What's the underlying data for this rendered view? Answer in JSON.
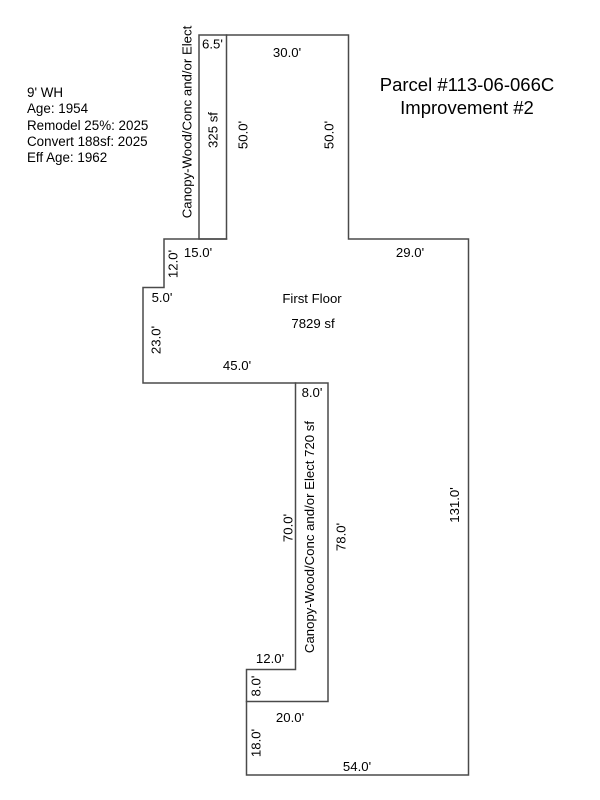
{
  "colors": {
    "line": "#4a4a4a",
    "text": "#000000",
    "background": "#ffffff"
  },
  "info_block": {
    "lines": [
      "9' WH",
      "Age: 1954",
      "Remodel 25%: 2025",
      "Convert 188sf: 2025",
      "Eff Age: 1962"
    ]
  },
  "title": {
    "parcel": "Parcel #113-06-066C",
    "improvement": "Improvement #2"
  },
  "first_floor": {
    "label": "First Floor",
    "area": "7829 sf",
    "dims": {
      "top_width": "30.0'",
      "top_left_height": "50.0'",
      "top_right_height": "50.0'",
      "upper_step_width": "15.0'",
      "upper_step_height": "12.0'",
      "right_offset": "29.0'",
      "notch_width": "5.0'",
      "left_height": "23.0'",
      "bottom_width": "45.0'",
      "lower_left_height": "18.0'",
      "bottom_edge": "54.0'",
      "right_height": "131.0'"
    }
  },
  "top_canopy": {
    "label": "Canopy-Wood/Conc and/or Elect",
    "area": "325 sf",
    "dims": {
      "width": "6.5'"
    }
  },
  "lower_canopy": {
    "label": "Canopy-Wood/Conc and/or Elect  720 sf",
    "dims": {
      "top_width": "8.0'",
      "left_height": "70.0'",
      "right_height": "78.0'",
      "foot_width": "12.0'",
      "foot_height": "8.0'",
      "bottom_width": "20.0'"
    }
  }
}
